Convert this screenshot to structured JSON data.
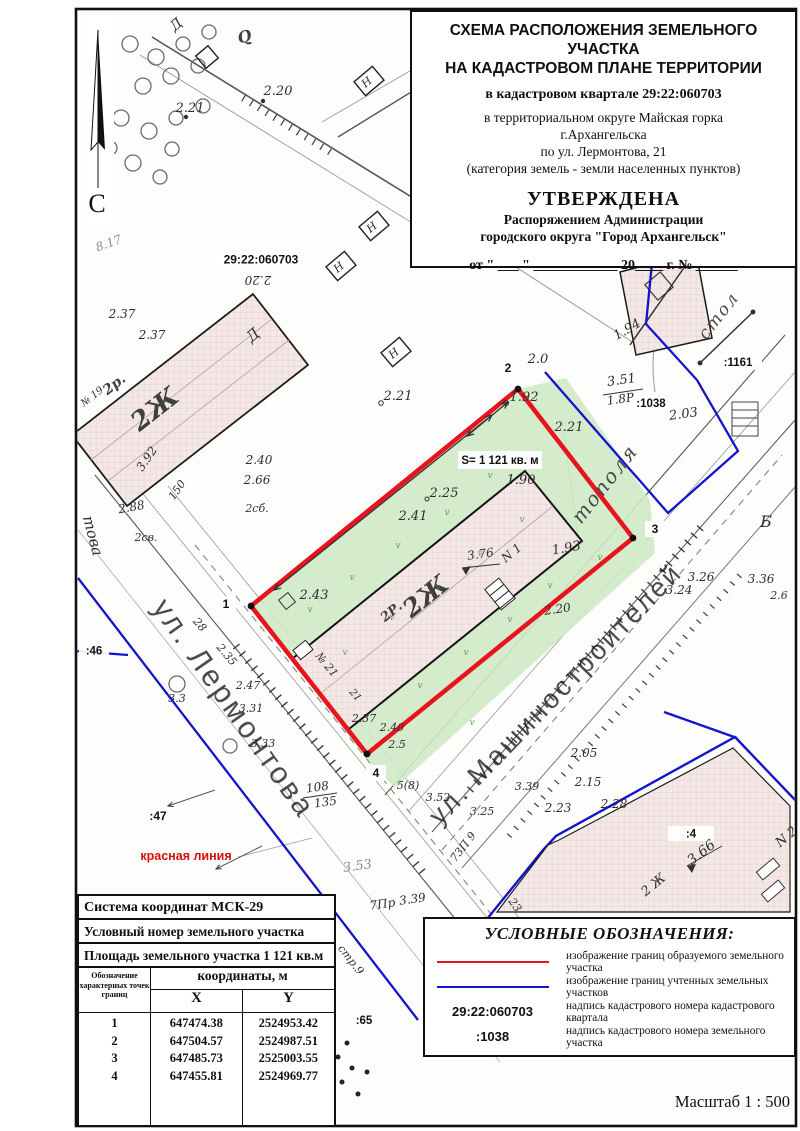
{
  "title_block": {
    "line1": "СХЕМА РАСПОЛОЖЕНИЯ ЗЕМЕЛЬНОГО УЧАСТКА",
    "line2": "НА КАДАСТРОВОМ ПЛАНЕ ТЕРРИТОРИИ",
    "quarter": "в кадастровом квартале 29:22:060703",
    "district1": "в территориальном округе Майская горка",
    "district2": "г.Архангельска",
    "address": "по ул. Лермонтова, 21",
    "category": "(категория земель - земли населенных пунктов)",
    "approved": "УТВЕРЖДЕНА",
    "approved_by1": "Распоряжением Администрации",
    "approved_by2": "городского округа \"Город Архангельск\"",
    "date_line": "от \" ___ \" ____________ 20____ г. № ______"
  },
  "north_label": "С",
  "scale_label": "Масштаб  1 : 500",
  "coord_table": {
    "row1": "Система координат МСК-29",
    "row2": "Условный номер земельного участка",
    "row3": "Площадь земельного участка 1 121 кв.м",
    "col_points": "Обозначение характерных точек границ",
    "col_coords": "координаты, м",
    "col_x": "X",
    "col_y": "Y",
    "points": [
      {
        "n": "1",
        "x": "647474.38",
        "y": "2524953.42"
      },
      {
        "n": "2",
        "x": "647504.57",
        "y": "2524987.51"
      },
      {
        "n": "3",
        "x": "647485.73",
        "y": "2525003.55"
      },
      {
        "n": "4",
        "x": "647455.81",
        "y": "2524969.77"
      }
    ]
  },
  "legend": {
    "title": "УСЛОВНЫЕ ОБОЗНАЧЕНИЯ:",
    "items": [
      {
        "symbol": "red-line",
        "text": "изображение границ образуемого земельного участка"
      },
      {
        "symbol": "blue-line",
        "text": "изображение границ учтенных земельных участков"
      },
      {
        "symbol": "29:22:060703",
        "text": "надпись кадастрового номера кадастрового квартала"
      },
      {
        "symbol": ":1038",
        "text": "надпись кадастрового номера земельного участка"
      }
    ]
  },
  "colors": {
    "red_boundary": "#e8131d",
    "blue_boundary": "#1414cc",
    "green_area": "#cfe9c6",
    "building_fill": "#f4e8e6",
    "red_label": "#d40f0f"
  },
  "map": {
    "boxes": [
      {
        "t": "29:22:060703",
        "x": 216,
        "y": 251,
        "w": 90,
        "h": 17,
        "s": 12
      },
      {
        "t": "S= 1 121 кв. м",
        "x": 458,
        "y": 451,
        "w": 84,
        "h": 18,
        "s": 11.5
      },
      {
        "t": "1",
        "x": 216,
        "y": 596,
        "w": 20,
        "h": 16,
        "s": 12
      },
      {
        "t": "2",
        "x": 498,
        "y": 360,
        "w": 20,
        "h": 16,
        "s": 12
      },
      {
        "t": "3",
        "x": 645,
        "y": 521,
        "w": 20,
        "h": 16,
        "s": 12
      },
      {
        "t": "4",
        "x": 366,
        "y": 765,
        "w": 20,
        "h": 16,
        "s": 12
      },
      {
        "t": ":46",
        "x": 79,
        "y": 643,
        "w": 30,
        "h": 15,
        "s": 11.5
      },
      {
        "t": ":65",
        "x": 348,
        "y": 1012,
        "w": 32,
        "h": 16,
        "s": 11.5
      },
      {
        "t": ":1161",
        "x": 714,
        "y": 354,
        "w": 48,
        "h": 16,
        "s": 11.5
      },
      {
        "t": ":1038",
        "x": 629,
        "y": 395,
        "w": 44,
        "h": 16,
        "s": 11.5
      },
      {
        "t": ":4",
        "x": 668,
        "y": 826,
        "w": 46,
        "h": 15,
        "s": 11.5
      }
    ],
    "labels": [
      {
        "t": "2.21",
        "x": 190,
        "y": 112,
        "r": 0,
        "s": 13,
        "c": "el"
      },
      {
        "t": "2.20",
        "x": 278,
        "y": 95,
        "r": 0,
        "s": 13,
        "c": "el"
      },
      {
        "t": "8.17",
        "x": 110,
        "y": 247,
        "r": -20,
        "s": 12,
        "c": "lt"
      },
      {
        "t": "2.20",
        "x": 258,
        "y": 276,
        "r": 180,
        "s": 12,
        "c": "el"
      },
      {
        "t": "2.37",
        "x": 122,
        "y": 318,
        "r": 0,
        "s": 12,
        "c": "el"
      },
      {
        "t": "2.37",
        "x": 152,
        "y": 339,
        "r": 0,
        "s": 12,
        "c": "el"
      },
      {
        "t": "2р.",
        "x": 117,
        "y": 388,
        "r": -38,
        "s": 14,
        "c": "bld"
      },
      {
        "t": "2Ж",
        "x": 160,
        "y": 416,
        "r": -38,
        "s": 26,
        "c": "bld"
      },
      {
        "t": "№ 19",
        "x": 94,
        "y": 399,
        "r": -38,
        "s": 10,
        "c": "el"
      },
      {
        "t": "3.92",
        "x": 150,
        "y": 461,
        "r": -55,
        "s": 12,
        "c": "el"
      },
      {
        "t": "150",
        "x": 180,
        "y": 492,
        "r": -55,
        "s": 11,
        "c": "el"
      },
      {
        "t": "2.40",
        "x": 259,
        "y": 464,
        "r": 0,
        "s": 12,
        "c": "el"
      },
      {
        "t": "2.66",
        "x": 257,
        "y": 484,
        "r": 0,
        "s": 12,
        "c": "el"
      },
      {
        "t": "2.88",
        "x": 132,
        "y": 511,
        "r": -10,
        "s": 12,
        "c": "el"
      },
      {
        "t": "2сб.",
        "x": 257,
        "y": 512,
        "r": 0,
        "s": 11,
        "c": "el"
      },
      {
        "t": "2св.",
        "x": 146,
        "y": 541,
        "r": 0,
        "s": 11,
        "c": "el"
      },
      {
        "t": "Д",
        "x": 256,
        "y": 339,
        "r": -40,
        "s": 15,
        "c": "el"
      },
      {
        "t": "Д",
        "x": 179,
        "y": 28,
        "r": -40,
        "s": 14,
        "c": "el"
      },
      {
        "t": "Q",
        "x": 246,
        "y": 42,
        "r": -15,
        "s": 16,
        "c": "bld"
      },
      {
        "t": "това",
        "x": 88,
        "y": 537,
        "r": 75,
        "s": 15,
        "c": "el"
      },
      {
        "t": "Н",
        "x": 369,
        "y": 85,
        "r": -40,
        "s": 11,
        "c": "el"
      },
      {
        "t": "Н",
        "x": 374,
        "y": 230,
        "r": -40,
        "s": 11,
        "c": "el"
      },
      {
        "t": "Н",
        "x": 341,
        "y": 270,
        "r": -40,
        "s": 11,
        "c": "el"
      },
      {
        "t": "Н",
        "x": 396,
        "y": 356,
        "r": -40,
        "s": 11,
        "c": "el"
      },
      {
        "t": "2.21",
        "x": 398,
        "y": 400,
        "r": 0,
        "s": 13,
        "c": "el"
      },
      {
        "t": "2.25",
        "x": 444,
        "y": 497,
        "r": 0,
        "s": 13,
        "c": "el"
      },
      {
        "t": "2.41",
        "x": 413,
        "y": 520,
        "r": 0,
        "s": 13,
        "c": "el"
      },
      {
        "t": "2.43",
        "x": 314,
        "y": 599,
        "r": 0,
        "s": 13,
        "c": "el"
      },
      {
        "t": "1.92",
        "x": 524,
        "y": 401,
        "r": 0,
        "s": 13,
        "c": "el"
      },
      {
        "t": "2.0",
        "x": 538,
        "y": 363,
        "r": 0,
        "s": 13,
        "c": "el"
      },
      {
        "t": "2.21",
        "x": 569,
        "y": 431,
        "r": 0,
        "s": 13,
        "c": "el"
      },
      {
        "t": "1.90",
        "x": 521,
        "y": 484,
        "r": 0,
        "s": 13,
        "c": "el"
      },
      {
        "t": "1.93",
        "x": 567,
        "y": 552,
        "r": -10,
        "s": 13,
        "c": "el"
      },
      {
        "t": "3.76",
        "x": 481,
        "y": 558,
        "r": -8,
        "s": 12,
        "c": "el"
      },
      {
        "t": "N 1",
        "x": 514,
        "y": 556,
        "r": -40,
        "s": 12,
        "c": "el"
      },
      {
        "t": "2Р.",
        "x": 394,
        "y": 615,
        "r": -39,
        "s": 13,
        "c": "bld"
      },
      {
        "t": "2Ж",
        "x": 431,
        "y": 603,
        "r": -39,
        "s": 25,
        "c": "bld"
      },
      {
        "t": "№ 21",
        "x": 324,
        "y": 667,
        "r": 50,
        "s": 11,
        "c": "el"
      },
      {
        "t": "21",
        "x": 353,
        "y": 697,
        "r": 50,
        "s": 10,
        "c": "el"
      },
      {
        "t": "2.20",
        "x": 558,
        "y": 613,
        "r": -8,
        "s": 12,
        "c": "el"
      },
      {
        "t": "2.35",
        "x": 224,
        "y": 657,
        "r": 50,
        "s": 11,
        "c": "el"
      },
      {
        "t": "28",
        "x": 197,
        "y": 627,
        "r": 50,
        "s": 11,
        "c": "el"
      },
      {
        "t": "2.47",
        "x": 248,
        "y": 689,
        "r": 0,
        "s": 11,
        "c": "el"
      },
      {
        "t": "3.31",
        "x": 251,
        "y": 712,
        "r": 0,
        "s": 11,
        "c": "el"
      },
      {
        "t": "3.3",
        "x": 177,
        "y": 702,
        "r": 0,
        "s": 11,
        "c": "el"
      },
      {
        "t": "3.33",
        "x": 263,
        "y": 747,
        "r": 0,
        "s": 11,
        "c": "el"
      },
      {
        "t": "2.37",
        "x": 364,
        "y": 722,
        "r": 0,
        "s": 11,
        "c": "el"
      },
      {
        "t": "2.40",
        "x": 392,
        "y": 731,
        "r": 0,
        "s": 11,
        "c": "el"
      },
      {
        "t": "2.5",
        "x": 397,
        "y": 748,
        "r": 0,
        "s": 11,
        "c": "el"
      },
      {
        "t": "108",
        "x": 318,
        "y": 791,
        "r": -8,
        "s": 12,
        "c": "el"
      },
      {
        "t": "135",
        "x": 326,
        "y": 806,
        "r": -8,
        "s": 12,
        "c": "el"
      },
      {
        "t": "5(8)",
        "x": 408,
        "y": 789,
        "r": 0,
        "s": 11,
        "c": "el"
      },
      {
        "t": "3.52",
        "x": 438,
        "y": 801,
        "r": 0,
        "s": 11,
        "c": "el"
      },
      {
        "t": "3.25",
        "x": 482,
        "y": 815,
        "r": 0,
        "s": 11,
        "c": "el"
      },
      {
        "t": "3.39",
        "x": 527,
        "y": 790,
        "r": 0,
        "s": 11,
        "c": "el"
      },
      {
        "t": "2.23",
        "x": 558,
        "y": 812,
        "r": 0,
        "s": 12,
        "c": "el"
      },
      {
        "t": "2.28",
        "x": 614,
        "y": 808,
        "r": 0,
        "s": 12,
        "c": "el"
      },
      {
        "t": "2.15",
        "x": 588,
        "y": 786,
        "r": 0,
        "s": 12,
        "c": "el"
      },
      {
        "t": "2.05",
        "x": 584,
        "y": 757,
        "r": 0,
        "s": 12,
        "c": "el"
      },
      {
        "t": "3.24",
        "x": 679,
        "y": 594,
        "r": 0,
        "s": 12,
        "c": "el"
      },
      {
        "t": "3.26",
        "x": 701,
        "y": 581,
        "r": 0,
        "s": 12,
        "c": "el"
      },
      {
        "t": "3.36",
        "x": 761,
        "y": 583,
        "r": 0,
        "s": 12,
        "c": "el"
      },
      {
        "t": "2.6",
        "x": 779,
        "y": 599,
        "r": 0,
        "s": 11,
        "c": "el"
      },
      {
        "t": "Б",
        "x": 766,
        "y": 527,
        "r": 0,
        "s": 16,
        "c": "el"
      },
      {
        "t": "2.03",
        "x": 684,
        "y": 418,
        "r": -8,
        "s": 13,
        "c": "el"
      },
      {
        "t": "1.94",
        "x": 629,
        "y": 333,
        "r": -30,
        "s": 13,
        "c": "el"
      },
      {
        "t": "3.51",
        "x": 622,
        "y": 384,
        "r": -8,
        "s": 13,
        "c": "el"
      },
      {
        "t": "1.8Р",
        "x": 621,
        "y": 403,
        "r": -8,
        "s": 12,
        "c": "el"
      },
      {
        "t": "3.53",
        "x": 358,
        "y": 870,
        "r": -8,
        "s": 13,
        "c": "lt"
      },
      {
        "t": "3.39",
        "x": 413,
        "y": 903,
        "r": -8,
        "s": 12,
        "c": "el"
      },
      {
        "t": "7Пр",
        "x": 383,
        "y": 908,
        "r": -8,
        "s": 12,
        "c": "el"
      },
      {
        "t": "стр.9",
        "x": 348,
        "y": 962,
        "r": 52,
        "s": 11,
        "c": "el"
      },
      {
        "t": "73П 9",
        "x": 466,
        "y": 849,
        "r": -52,
        "s": 11,
        "c": "el"
      },
      {
        "t": "23",
        "x": 512,
        "y": 907,
        "r": 55,
        "s": 11,
        "c": "el"
      },
      {
        "t": "тополя",
        "x": 610,
        "y": 488,
        "r": -52,
        "s": 20,
        "c": "top"
      },
      {
        "t": "стол",
        "x": 723,
        "y": 319,
        "r": -52,
        "s": 17,
        "c": "top"
      },
      {
        "t": "2 Ж",
        "x": 656,
        "y": 888,
        "r": -40,
        "s": 13,
        "c": "el"
      },
      {
        "t": "3.66",
        "x": 704,
        "y": 856,
        "r": -38,
        "s": 14,
        "c": "el"
      },
      {
        "t": "N 2",
        "x": 789,
        "y": 840,
        "r": -40,
        "s": 13,
        "c": "el"
      },
      {
        "t": ":47",
        "x": 158,
        "y": 820,
        "r": 0,
        "s": 12,
        "c": "cad"
      },
      {
        "t": "красная линия",
        "x": 186,
        "y": 860,
        "r": 0,
        "s": 12.5,
        "c": "red"
      },
      {
        "t": "ул. Лермонтова",
        "x": 226,
        "y": 714,
        "r": 55,
        "s": 30,
        "c": "street"
      },
      {
        "t": "ул. Машиностроителей",
        "x": 562,
        "y": 700,
        "r": -46,
        "s": 27,
        "c": "street"
      },
      {
        "t": "v",
        "x": 310,
        "y": 612,
        "r": 0,
        "s": 9,
        "c": "vm"
      },
      {
        "t": "v",
        "x": 352,
        "y": 580,
        "r": 0,
        "s": 9,
        "c": "vm"
      },
      {
        "t": "v",
        "x": 398,
        "y": 548,
        "r": 0,
        "s": 9,
        "c": "vm"
      },
      {
        "t": "v",
        "x": 447,
        "y": 515,
        "r": 0,
        "s": 9,
        "c": "vm"
      },
      {
        "t": "v",
        "x": 490,
        "y": 478,
        "r": 0,
        "s": 9,
        "c": "vm"
      },
      {
        "t": "v",
        "x": 345,
        "y": 655,
        "r": 0,
        "s": 9,
        "c": "vm"
      },
      {
        "t": "v",
        "x": 392,
        "y": 620,
        "r": 0,
        "s": 9,
        "c": "vm"
      },
      {
        "t": "v",
        "x": 438,
        "y": 590,
        "r": 0,
        "s": 9,
        "c": "vm"
      },
      {
        "t": "v",
        "x": 480,
        "y": 556,
        "r": 0,
        "s": 9,
        "c": "vm"
      },
      {
        "t": "v",
        "x": 522,
        "y": 522,
        "r": 0,
        "s": 9,
        "c": "vm"
      },
      {
        "t": "v",
        "x": 420,
        "y": 688,
        "r": 0,
        "s": 9,
        "c": "vm"
      },
      {
        "t": "v",
        "x": 466,
        "y": 655,
        "r": 0,
        "s": 9,
        "c": "vm"
      },
      {
        "t": "v",
        "x": 510,
        "y": 622,
        "r": 0,
        "s": 9,
        "c": "vm"
      },
      {
        "t": "v",
        "x": 550,
        "y": 588,
        "r": 0,
        "s": 9,
        "c": "vm"
      },
      {
        "t": "v",
        "x": 472,
        "y": 725,
        "r": 0,
        "s": 9,
        "c": "vm"
      },
      {
        "t": "v",
        "x": 600,
        "y": 560,
        "r": 0,
        "s": 9,
        "c": "vm"
      }
    ]
  }
}
